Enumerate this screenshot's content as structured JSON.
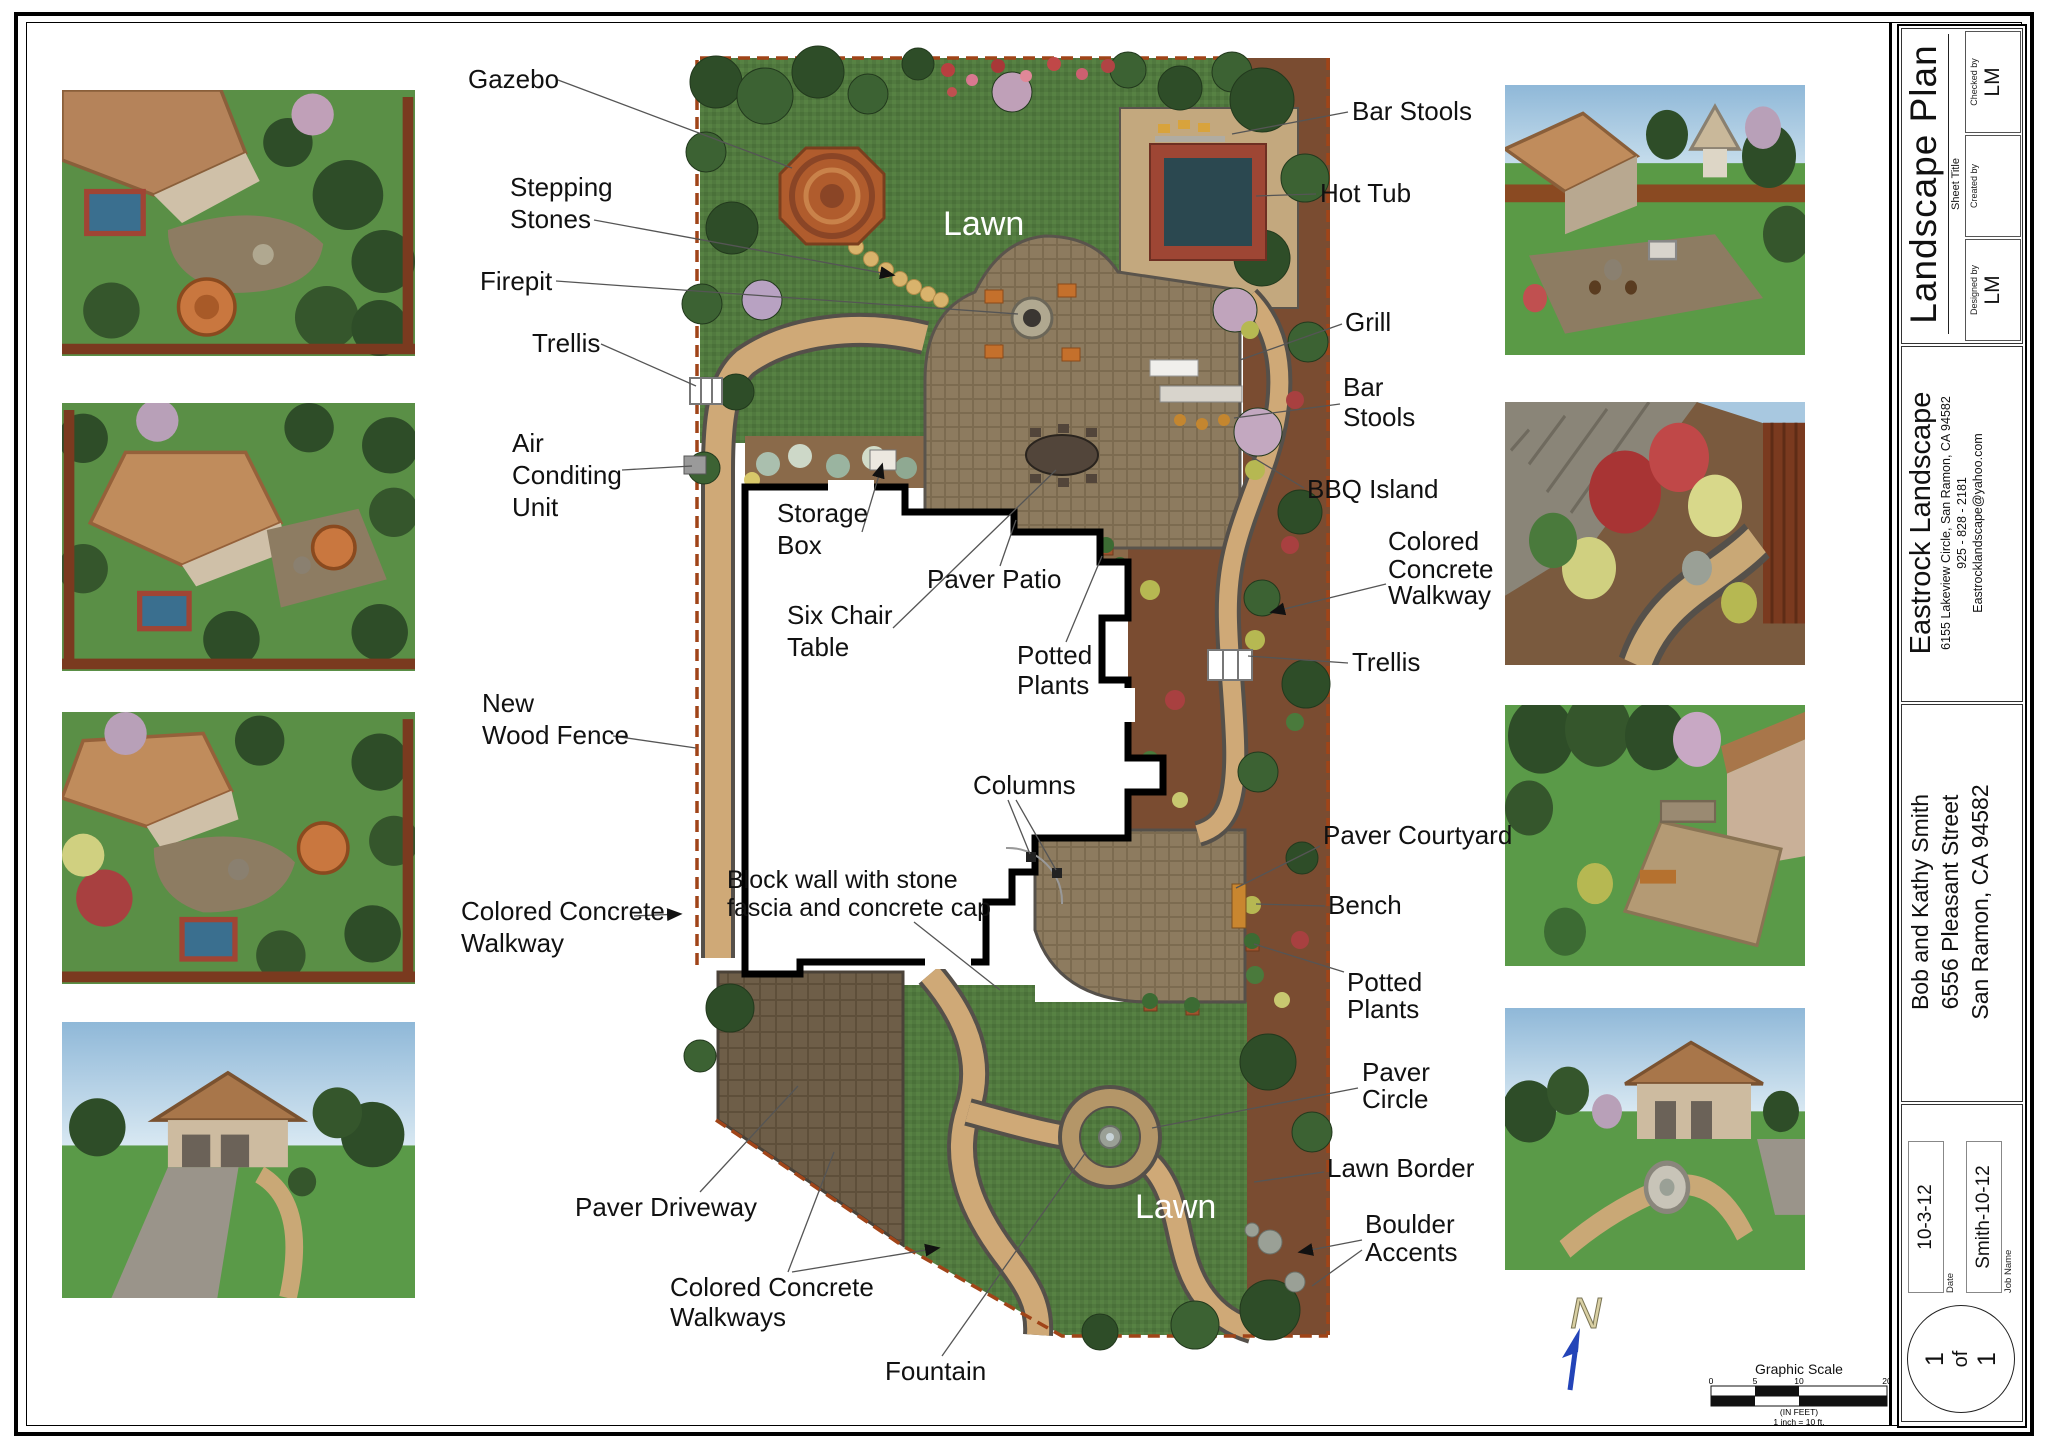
{
  "sheet": {
    "title": "Landscape Plan",
    "sheet_title_label": "Sheet Title",
    "byline": {
      "checked": {
        "label": "Checked by",
        "value": "LM"
      },
      "created": {
        "label": "Created by",
        "value": ""
      },
      "designed": {
        "label": "Designed by",
        "value": "LM"
      }
    },
    "company": {
      "name": "Eastrock Landscape",
      "address": "6155 Lakeview Circle, San Ramon, CA  94582",
      "phone": "925 - 828 - 2181",
      "email": "Eastrocklandscape@yahoo.com"
    },
    "client": {
      "name": "Bob and Kathy Smith",
      "street": "6556 Pleasant Street",
      "city": "San Ramon, CA  94582"
    },
    "fields": {
      "date_label": "Date",
      "date_value": "10-3-12",
      "job_label": "Job Name",
      "job_value": "Smith-10-12"
    },
    "page": {
      "first": "1",
      "mid": "of",
      "last": "1"
    }
  },
  "scalebar": {
    "title": "Graphic Scale",
    "ticks": [
      "0",
      "5",
      "10",
      "20"
    ],
    "feet_note": "(IN FEET)",
    "ratio_note": "1 inch = 10 ft."
  },
  "north": {
    "letter": "N"
  },
  "callouts": {
    "gazebo": {
      "lines": [
        "Gazebo"
      ]
    },
    "stepping_stones": {
      "lines": [
        "Stepping",
        "Stones"
      ]
    },
    "firepit": {
      "lines": [
        "Firepit"
      ]
    },
    "trellis_left": {
      "lines": [
        "Trellis"
      ]
    },
    "air_conditioning": {
      "lines": [
        "Air",
        "Conditing",
        "Unit"
      ]
    },
    "storage_box": {
      "lines": [
        "Storage",
        "Box"
      ]
    },
    "six_chair_table": {
      "lines": [
        "Six Chair",
        "Table"
      ]
    },
    "new_wood_fence": {
      "lines": [
        "New",
        "Wood Fence"
      ]
    },
    "colored_concrete_walkway_left": {
      "lines": [
        "Colored Concrete",
        "Walkway"
      ]
    },
    "paver_patio": {
      "lines": [
        "Paver Patio"
      ]
    },
    "potted_plants_center": {
      "lines": [
        "Potted",
        "Plants"
      ]
    },
    "columns": {
      "lines": [
        "Columns"
      ]
    },
    "block_wall": {
      "lines": [
        "Block wall with stone",
        "fascia and concrete cap"
      ]
    },
    "paver_driveway": {
      "lines": [
        "Paver Driveway"
      ]
    },
    "colored_concrete_walkways_bottom": {
      "lines": [
        "Colored Concrete",
        "Walkways"
      ]
    },
    "fountain": {
      "lines": [
        "Fountain"
      ]
    },
    "bar_stools_top": {
      "lines": [
        "Bar Stools"
      ]
    },
    "hot_tub": {
      "lines": [
        "Hot Tub"
      ]
    },
    "grill": {
      "lines": [
        "Grill"
      ]
    },
    "bar_stools_2": {
      "lines": [
        "Bar",
        "Stools"
      ]
    },
    "bbq_island": {
      "lines": [
        "BBQ Island"
      ]
    },
    "colored_concrete_walkway_right": {
      "lines": [
        "Colored",
        "Concrete",
        "Walkway"
      ]
    },
    "trellis_right": {
      "lines": [
        "Trellis"
      ]
    },
    "paver_courtyard": {
      "lines": [
        "Paver Courtyard"
      ]
    },
    "bench": {
      "lines": [
        "Bench"
      ]
    },
    "potted_plants_right": {
      "lines": [
        "Potted",
        "Plants"
      ]
    },
    "paver_circle": {
      "lines": [
        "Paver",
        "Circle"
      ]
    },
    "lawn_border": {
      "lines": [
        "Lawn Border"
      ]
    },
    "boulder_accents": {
      "lines": [
        "Boulder",
        "Accents"
      ]
    },
    "lawn_top": {
      "lines": [
        "Lawn"
      ]
    },
    "lawn_bottom": {
      "lines": [
        "Lawn"
      ]
    }
  },
  "colors": {
    "lawn_green": "#51793f",
    "paver_brown": "#8d7b5f",
    "driveway_brown": "#6e5e48",
    "walkway_tan": "#cfa977",
    "mulch": "#7a4c31",
    "fence_red": "#a04418",
    "hot_tub_water": "#2b4850",
    "north_arrow_blue": "#2344b8"
  }
}
